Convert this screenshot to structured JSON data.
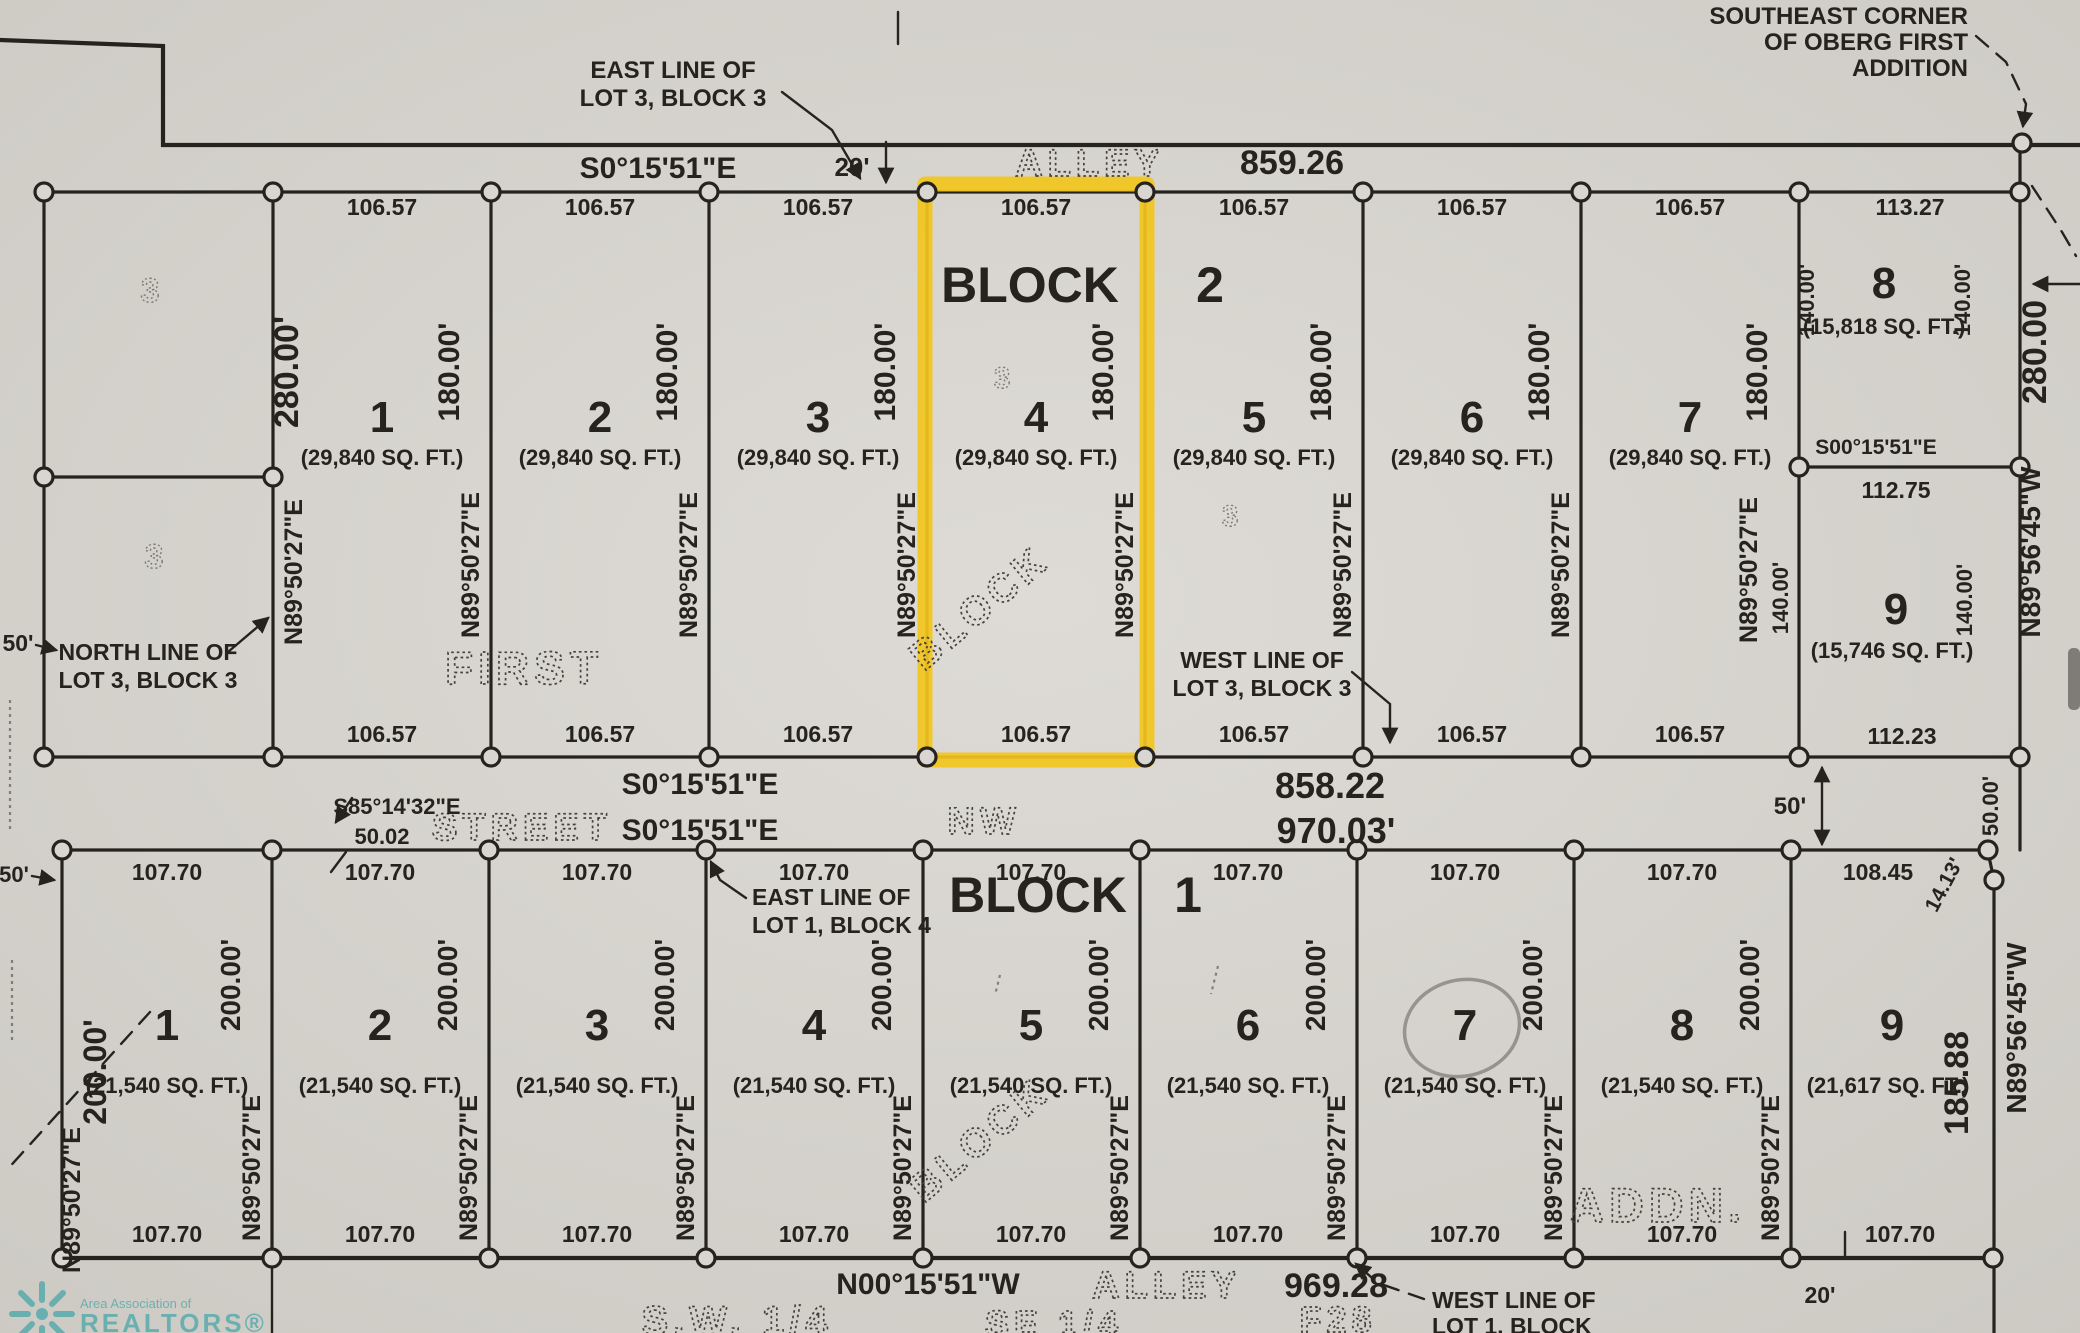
{
  "palette": {
    "paper": "#d9d6d1",
    "ink": "#26231f",
    "highlight": "#F2C51D",
    "logo_teal": "#2E9FA4"
  },
  "top": {
    "east_line_note_1": "EAST LINE OF",
    "east_line_note_2": "LOT 3, BLOCK 3",
    "se_corner_note_1": "SOUTHEAST CORNER",
    "se_corner_note_2": "OF OBERG FIRST",
    "se_corner_note_3": "ADDITION",
    "bearing": "S0°15'51\"E",
    "alley_width": "20'",
    "alley": "ALLEY",
    "alley_dist": "859.26"
  },
  "b2": {
    "block_word": "BLOCK",
    "block_num": "2",
    "lots": [
      {
        "num": "1",
        "top": "106.57",
        "bottom": "106.57",
        "sqft": "(29,840 SQ. FT.)",
        "side": "180.00'",
        "bearing": "N89°50'27\"E"
      },
      {
        "num": "2",
        "top": "106.57",
        "bottom": "106.57",
        "sqft": "(29,840 SQ. FT.)",
        "side": "180.00'",
        "bearing": "N89°50'27\"E"
      },
      {
        "num": "3",
        "top": "106.57",
        "bottom": "106.57",
        "sqft": "(29,840 SQ. FT.)",
        "side": "180.00'",
        "bearing": "N89°50'27\"E"
      },
      {
        "num": "4",
        "top": "106.57",
        "bottom": "106.57",
        "sqft": "(29,840 SQ. FT.)",
        "side": "180.00'",
        "bearing": "N89°50'27\"E"
      },
      {
        "num": "5",
        "top": "106.57",
        "bottom": "106.57",
        "sqft": "(29,840 SQ. FT.)",
        "side": "180.00'",
        "bearing": "N89°50'27\"E"
      },
      {
        "num": "6",
        "top": "106.57",
        "bottom": "106.57",
        "sqft": "(29,840 SQ. FT.)",
        "side": "180.00'",
        "bearing": "N89°50'27\"E"
      },
      {
        "num": "7",
        "top": "106.57",
        "bottom": "106.57",
        "sqft": "(29,840 SQ. FT.)",
        "side": "180.00'",
        "bearing": "N89°50'27\"E"
      },
      {
        "num": "8",
        "top": "113.27",
        "sqft": "(15,818 SQ. FT.)",
        "side_l": "140.00'",
        "side_r": "140.00'",
        "bot_bearing": "S00°15'51\"E",
        "bottom": "112.75"
      },
      {
        "num": "9",
        "sqft": "(15,746 SQ. FT.)",
        "side_l": "140.00'",
        "side_r": "140.00'",
        "bottom": "112.23"
      }
    ],
    "lot1_left_dim": "280.00'",
    "lot1_left_bearing": "N89°50'27\"E",
    "right_dim": "280.00",
    "right_bearing": "N89°56'45\"W",
    "first_dotted": "FIRST",
    "block_dotted": "BLOCK",
    "faint_digit": "3",
    "west_line_note_1": "WEST LINE OF",
    "west_line_note_2": "LOT 3, BLOCK 3",
    "north_line_note_1": "NORTH LINE OF",
    "north_line_note_2": "LOT 3, BLOCK 3",
    "fifty": "50'"
  },
  "street": {
    "bearing_upper": "S0°15'51\"E",
    "dist_upper": "858.22",
    "bearing_lower": "S0°15'51\"E",
    "dist_lower": "970.03'",
    "street_dotted": "STREET",
    "nw_dotted": "NW",
    "s85_bearing": "S85°14'32\"E",
    "s85_dist": "50.02",
    "width": "50'",
    "width_right": "50.00'"
  },
  "b1": {
    "block_word": "BLOCK",
    "block_num": "1",
    "east_line_note_1": "EAST LINE OF",
    "east_line_note_2": "LOT 1, BLOCK 4",
    "lots": [
      {
        "num": "1",
        "top": "107.70",
        "bottom": "107.70",
        "sqft": "(21,540 SQ. FT.)",
        "side": "200.00'",
        "bearing": "N89°50'27\"E"
      },
      {
        "num": "2",
        "top": "107.70",
        "bottom": "107.70",
        "sqft": "(21,540 SQ. FT.)",
        "side": "200.00'",
        "bearing": "N89°50'27\"E"
      },
      {
        "num": "3",
        "top": "107.70",
        "bottom": "107.70",
        "sqft": "(21,540 SQ. FT.)",
        "side": "200.00'",
        "bearing": "N89°50'27\"E"
      },
      {
        "num": "4",
        "top": "107.70",
        "bottom": "107.70",
        "sqft": "(21,540 SQ. FT.)",
        "side": "200.00'",
        "bearing": "N89°50'27\"E"
      },
      {
        "num": "5",
        "top": "107.70",
        "bottom": "107.70",
        "sqft": "(21,540 SQ. FT.)",
        "side": "200.00'",
        "bearing": "N89°50'27\"E"
      },
      {
        "num": "6",
        "top": "107.70",
        "bottom": "107.70",
        "sqft": "(21,540 SQ. FT.)",
        "side": "200.00'",
        "bearing": "N89°50'27\"E"
      },
      {
        "num": "7",
        "top": "107.70",
        "bottom": "107.70",
        "sqft": "(21,540 SQ. FT.)",
        "side": "200.00'",
        "bearing": "N89°50'27\"E"
      },
      {
        "num": "8",
        "top": "107.70",
        "bottom": "107.70",
        "sqft": "(21,540 SQ. FT.)",
        "side": "200.00'",
        "bearing": "N89°50'27\"E"
      },
      {
        "num": "9",
        "top": "108.45",
        "bottom": "107.70",
        "sqft": "(21,617 SQ. FT.)"
      }
    ],
    "left_fifty": "50'",
    "left_dim": "200.00'",
    "left_bearing": "N89°50'27\"E",
    "jog": "14.13'",
    "right_dim": "185.88",
    "right_bearing": "N89°56'45\"W",
    "addn_dotted": "ADDN.",
    "block_dotted": "BLOCK"
  },
  "bottom": {
    "bearing": "N00°15'51\"W",
    "alley": "ALLEY",
    "dist": "969.28",
    "twenty": "20'",
    "west_line_note_1": "WEST LINE OF",
    "west_line_note_2": "LOT 1, BLOCK",
    "frag_sw": "S.W. 1/4",
    "frag_se": "SE 1/4",
    "frag_f": "F28"
  },
  "logo": {
    "line1": "Area Association of",
    "line2": "REALTORS®"
  }
}
